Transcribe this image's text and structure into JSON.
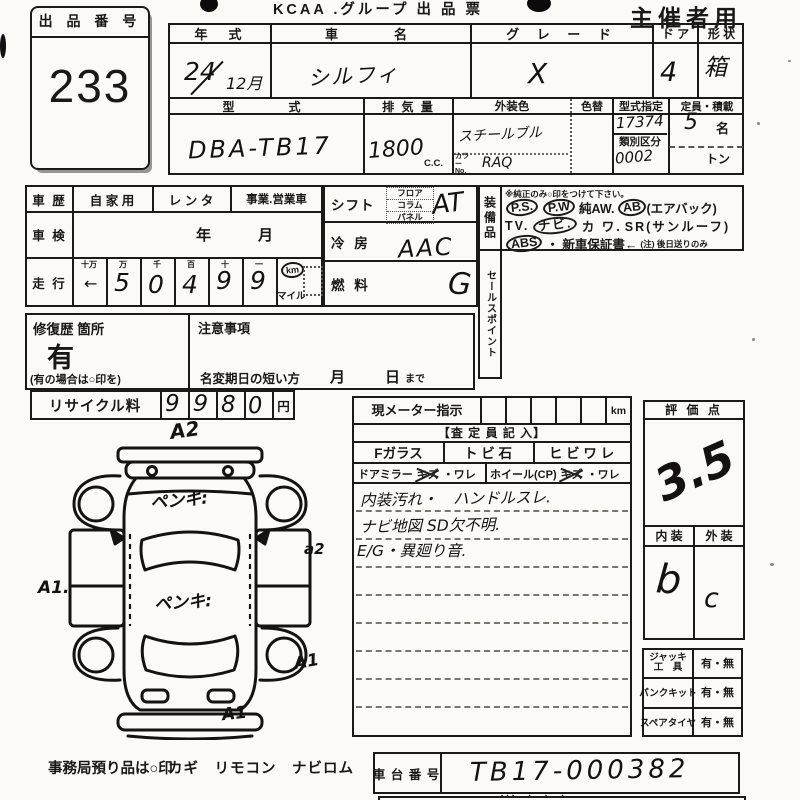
{
  "header": {
    "title": "KCAA .グループ 出 品 票",
    "audience": "主催者用"
  },
  "exhibit": {
    "label": "出 品 番 号",
    "number": "233"
  },
  "spec": {
    "year": {
      "label": "年　式",
      "top": "24",
      "bottom": "12月"
    },
    "name": {
      "label": "車　　名",
      "value": "シルフィ"
    },
    "grade": {
      "label": "グ レ ー ド",
      "value": "X"
    },
    "door": {
      "label": "ド ア",
      "value": "4"
    },
    "shape": {
      "label": "形 状",
      "value": "箱"
    },
    "model": {
      "label": "型　　式",
      "value": "DBA-TB17"
    },
    "displacement": {
      "label": "排 気 量",
      "value": "1800",
      "unit": "C.C."
    },
    "body_color": {
      "label": "外装色",
      "value": "スチールブル",
      "color_no_label": "カラーNo.",
      "color_no": "RAQ"
    },
    "recolor": {
      "label": "色替"
    },
    "type_no": {
      "label": "型式指定",
      "value": "17374"
    },
    "class_no": {
      "label": "類別区分",
      "value": "0002"
    },
    "capacity": {
      "label": "定員・積載",
      "value": "5",
      "unit": "名",
      "ton": "トン"
    }
  },
  "usage": {
    "history_label": "車 歴",
    "options": [
      "自 家 用",
      "レ ン タ",
      "事業.営業車"
    ],
    "shaken_label": "車 検",
    "year": "年",
    "month": "月"
  },
  "mileage": {
    "label": "走 行",
    "headers": [
      "十万",
      "万",
      "千",
      "百",
      "十",
      "一"
    ],
    "digits": [
      "5",
      "0",
      "4",
      "9",
      "9"
    ],
    "arrow": "←",
    "km": "km",
    "mile": "マイル"
  },
  "controls": {
    "shift_label": "シフト",
    "shift_options": [
      "フロア",
      "コラム",
      "パネル"
    ],
    "shift_value": "AT",
    "aircon_label": "冷 房",
    "aircon_value": "AAC",
    "fuel_label": "燃 料",
    "fuel_value": "G"
  },
  "equipment": {
    "label": "装備品",
    "note": "※純正のみ○印をつけて下さい。",
    "lines": [
      [
        {
          "text": "P.S.",
          "circled": true
        },
        {
          "text": "P.W",
          "circled": true
        },
        {
          "text": "純AW.",
          "circled": false
        },
        {
          "text": "AB",
          "circled": true
        },
        {
          "text": "(エアバック)",
          "circled": false
        }
      ],
      [
        {
          "text": "TV.",
          "circled": false
        },
        {
          "text": "ナビ.",
          "circled": true
        },
        {
          "text": "カ ワ.",
          "circled": false
        },
        {
          "text": "SR(サンルーフ)",
          "circled": false
        }
      ],
      [
        {
          "text": "ABS",
          "circled": true
        },
        {
          "text": "・ 新車保証書←",
          "circled": false
        },
        {
          "text": "(注) 後日送りのみ",
          "circled": false
        }
      ]
    ]
  },
  "sales_point": {
    "label": "セールスポイント"
  },
  "repair": {
    "label": "修復歴 箇所",
    "value": "有",
    "note": "(有の場合は○印を)"
  },
  "caution": {
    "label": "注意事項",
    "rename_label": "名変期日の短い方",
    "month": "月",
    "day": "日",
    "until": "まで"
  },
  "recycle": {
    "label": "リサイクル料",
    "digits": [
      "9",
      "9",
      "8",
      "0"
    ],
    "unit": "円"
  },
  "meter": {
    "label": "現メーター指示",
    "unit": "km"
  },
  "assessor": {
    "header": "【査 定 員 記 入】",
    "glass": [
      "Fガラス",
      "ト ビ 石",
      "ヒ ビ ワ レ"
    ],
    "mirror_label": "ドアミラー",
    "mirror_struck": "キズ",
    "mirror_rest": "・ワレ",
    "wheel_label": "ホイール(CP)",
    "wheel_struck": "キズ",
    "wheel_rest": "・ワレ",
    "notes": [
      "内装汚れ・　ハンドルスレ.",
      "ナビ地図 SD欠不明.",
      "E/G・異廻り音."
    ]
  },
  "score": {
    "label": "評 価 点",
    "value": "3.5"
  },
  "grades": {
    "interior_label": "内 装",
    "interior": "b",
    "exterior_label": "外 装",
    "exterior": "c"
  },
  "tools": {
    "rows": [
      {
        "label": "ジャッキ\n工　具",
        "value": "有・無"
      },
      {
        "label": "パンクキット",
        "value": "有・無"
      },
      {
        "label": "スペアタイヤ",
        "value": "有・無"
      }
    ]
  },
  "chassis": {
    "label": "車 台 番 号",
    "value": "TB17-000382",
    "ticks": "、、、　、　、　、"
  },
  "footer": {
    "label": "事務局預り品は○印",
    "items": "カギ　リモコン　ナビロム"
  },
  "diagram": {
    "annotations": [
      "A2",
      "ペンキ:",
      "A1.",
      "a2",
      "ペンキ:",
      "A1",
      "A1"
    ]
  }
}
